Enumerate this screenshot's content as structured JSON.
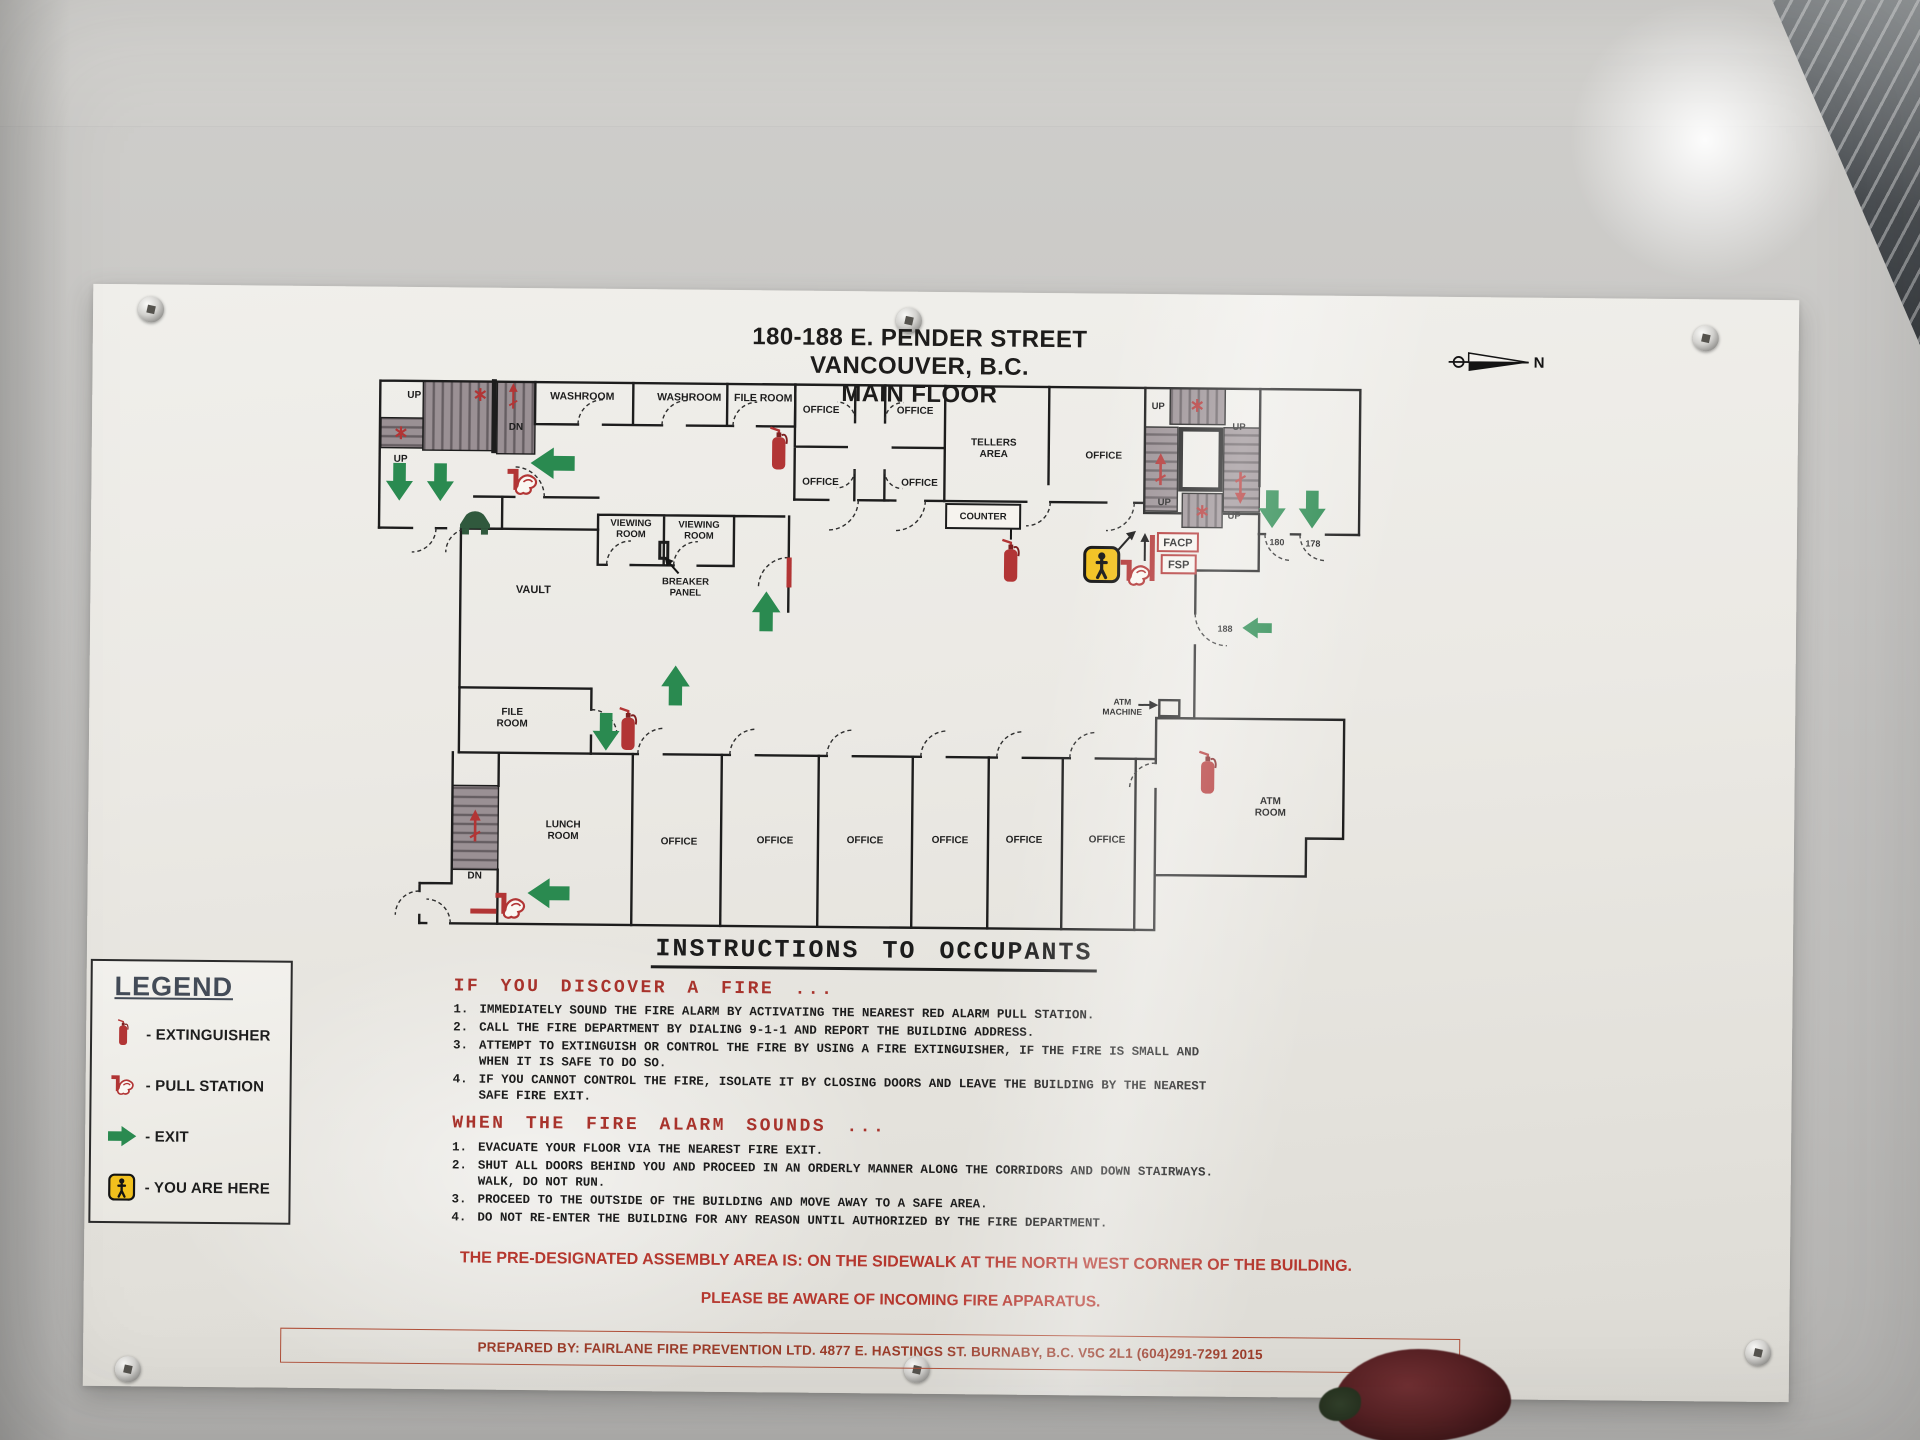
{
  "sign": {
    "title_lines": [
      "180-188 E. PENDER STREET",
      "VANCOUVER, B.C.",
      "MAIN FLOOR"
    ],
    "compass": {
      "label": "N"
    },
    "colors": {
      "alarm_red": "#b23535",
      "exit_green": "#2a8a50",
      "here_yellow": "#f2c11e",
      "heading_red": "#a8332c",
      "stair_fill": "#9a9094"
    },
    "floor_plan": {
      "labels": [
        {
          "t": "UP",
          "x": 39,
          "y": 20,
          "s": 10
        },
        {
          "t": "DN",
          "x": 141,
          "y": 51,
          "s": 10
        },
        {
          "t": "UP",
          "x": 26,
          "y": 84,
          "s": 10
        },
        {
          "t": "WASHROOM",
          "x": 207,
          "y": 20,
          "s": 10.5
        },
        {
          "t": "WASHROOM",
          "x": 314,
          "y": 20,
          "s": 10.5
        },
        {
          "t": "FILE ROOM",
          "x": 388,
          "y": 20,
          "s": 10.5
        },
        {
          "t": "OFFICE",
          "x": 446,
          "y": 31,
          "s": 10
        },
        {
          "t": "OFFICE",
          "x": 540,
          "y": 31,
          "s": 10
        },
        {
          "t": "OFFICE",
          "x": 446,
          "y": 103,
          "s": 10
        },
        {
          "t": "OFFICE",
          "x": 545,
          "y": 103,
          "s": 10
        },
        {
          "t": "TELLERS\nAREA",
          "x": 619,
          "y": 62,
          "s": 10
        },
        {
          "t": "OFFICE",
          "x": 729,
          "y": 74,
          "s": 10
        },
        {
          "t": "UP",
          "x": 783,
          "y": 24,
          "s": 9.5
        },
        {
          "t": "UP",
          "x": 864,
          "y": 44,
          "s": 9.5
        },
        {
          "t": "UP",
          "x": 790,
          "y": 120,
          "s": 9.5
        },
        {
          "t": "UP",
          "x": 860,
          "y": 133,
          "s": 9.5
        },
        {
          "t": "180",
          "x": 903,
          "y": 159,
          "s": 9
        },
        {
          "t": "178",
          "x": 939,
          "y": 160,
          "s": 9
        },
        {
          "t": "188",
          "x": 852,
          "y": 246,
          "s": 9
        },
        {
          "t": "VIEWING\nROOM",
          "x": 257,
          "y": 146,
          "s": 9.5
        },
        {
          "t": "VIEWING\nROOM",
          "x": 325,
          "y": 147,
          "s": 9.5
        },
        {
          "t": "BREAKER\nPANEL",
          "x": 312,
          "y": 204,
          "s": 9.5
        },
        {
          "t": "VAULT",
          "x": 160,
          "y": 214,
          "s": 11
        },
        {
          "t": "FILE\nROOM",
          "x": 140,
          "y": 336,
          "s": 10
        },
        {
          "t": "LUNCH\nROOM",
          "x": 192,
          "y": 448,
          "s": 10
        },
        {
          "t": "DN",
          "x": 104,
          "y": 500,
          "s": 10
        },
        {
          "t": "OFFICE",
          "x": 308,
          "y": 464,
          "s": 10
        },
        {
          "t": "OFFICE",
          "x": 404,
          "y": 462,
          "s": 10
        },
        {
          "t": "OFFICE",
          "x": 494,
          "y": 461,
          "s": 10
        },
        {
          "t": "OFFICE",
          "x": 579,
          "y": 460,
          "s": 10
        },
        {
          "t": "OFFICE",
          "x": 653,
          "y": 459,
          "s": 10
        },
        {
          "t": "OFFICE",
          "x": 736,
          "y": 458,
          "s": 10
        },
        {
          "t": "ATM\nMACHINE",
          "x": 750,
          "y": 320,
          "s": 8.5
        },
        {
          "t": "ATM\nROOM",
          "x": 899,
          "y": 418,
          "s": 10
        }
      ],
      "boxed_labels": [
        {
          "t": "FACP",
          "x": 804,
          "y": 161,
          "s": 11,
          "box": [
            784,
            148,
            40,
            18
          ],
          "c": "#b23535"
        },
        {
          "t": "FSP",
          "x": 805,
          "y": 183,
          "s": 11,
          "box": [
            788,
            170,
            34,
            18
          ],
          "c": "#b23535"
        },
        {
          "t": "COUNTER",
          "x": 609,
          "y": 136,
          "s": 9.5,
          "box": [
            572,
            121,
            74,
            24
          ],
          "c": "#1d1d1d"
        }
      ],
      "icons": [
        {
          "type": "exit-arrow-icon",
          "x": 25,
          "y": 104,
          "rot": 0,
          "s": 0.9
        },
        {
          "type": "exit-arrow-icon",
          "x": 66,
          "y": 104,
          "rot": 0,
          "s": 0.9
        },
        {
          "type": "exit-arrow-icon",
          "x": 178,
          "y": 84,
          "rot": 90,
          "s": 1.05
        },
        {
          "type": "exit-arrow-icon",
          "x": 898,
          "y": 123,
          "rot": 0,
          "s": 0.9
        },
        {
          "type": "exit-arrow-icon",
          "x": 938,
          "y": 123,
          "rot": 0,
          "s": 0.9
        },
        {
          "type": "exit-arrow-icon",
          "x": 234,
          "y": 352,
          "rot": 0,
          "s": 0.9
        },
        {
          "type": "exit-arrow-icon",
          "x": 303,
          "y": 305,
          "rot": 180,
          "s": 0.95
        },
        {
          "type": "exit-arrow-icon",
          "x": 393,
          "y": 230,
          "rot": 180,
          "s": 0.95
        },
        {
          "type": "exit-arrow-icon",
          "x": 884,
          "y": 242,
          "rot": 90,
          "s": 0.7
        },
        {
          "type": "exit-arrow-icon",
          "x": 178,
          "y": 514,
          "rot": 90,
          "s": 1.0
        },
        {
          "type": "extinguisher-icon",
          "x": 404,
          "y": 70,
          "rot": 0,
          "s": 0.95
        },
        {
          "type": "extinguisher-icon",
          "x": 637,
          "y": 180,
          "rot": 0,
          "s": 0.95
        },
        {
          "type": "extinguisher-icon",
          "x": 256,
          "y": 352,
          "rot": 0,
          "s": 0.95
        },
        {
          "type": "extinguisher-icon",
          "x": 836,
          "y": 390,
          "rot": 0,
          "s": 0.95
        },
        {
          "type": "pull-station-icon",
          "x": 148,
          "y": 103,
          "rot": 0,
          "s": 1
        },
        {
          "type": "pull-station-icon",
          "x": 762,
          "y": 188,
          "rot": 0,
          "s": 1
        },
        {
          "type": "pull-station-icon",
          "x": 140,
          "y": 527,
          "rot": 0,
          "s": 1
        },
        {
          "type": "stair-arrow-icon",
          "x": 138,
          "y": 17,
          "rot": 0,
          "s": 0.8
        },
        {
          "type": "stair-arrow-icon",
          "x": 786,
          "y": 84,
          "rot": 0,
          "s": 1
        },
        {
          "type": "stair-arrow-icon",
          "x": 866,
          "y": 102,
          "rot": 180,
          "s": 1
        },
        {
          "type": "stair-arrow-icon",
          "x": 104,
          "y": 447,
          "rot": 0,
          "s": 1
        },
        {
          "type": "stair-marker-icon",
          "x": 105,
          "y": 16,
          "rot": 0,
          "s": 0.8
        },
        {
          "type": "stair-marker-icon",
          "x": 26,
          "y": 55,
          "rot": 0,
          "s": 0.8
        },
        {
          "type": "stair-marker-icon",
          "x": 822,
          "y": 20,
          "rot": 0,
          "s": 0.8
        },
        {
          "type": "stair-marker-icon",
          "x": 828,
          "y": 126,
          "rot": 0,
          "s": 0.8
        },
        {
          "type": "you-are-here-icon",
          "x": 728,
          "y": 180,
          "rot": 0,
          "s": 1
        },
        {
          "type": "equipment-icon",
          "x": 101,
          "y": 143,
          "rot": 0,
          "s": 1
        }
      ]
    },
    "legend": {
      "title": "LEGEND",
      "items": [
        {
          "icon": "extinguisher-icon",
          "label": "- EXTINGUISHER"
        },
        {
          "icon": "pull-station-icon",
          "label": "- PULL STATION"
        },
        {
          "icon": "exit-arrow-icon",
          "label": "- EXIT"
        },
        {
          "icon": "you-are-here-icon",
          "label": "- YOU ARE HERE"
        }
      ]
    },
    "instructions": {
      "heading": "INSTRUCTIONS TO OCCUPANTS",
      "sections": [
        {
          "title": "IF YOU DISCOVER A FIRE ...",
          "items": [
            "IMMEDIATELY SOUND THE FIRE ALARM BY ACTIVATING THE NEAREST RED ALARM PULL STATION.",
            "CALL THE FIRE DEPARTMENT BY DIALING 9-1-1 AND REPORT THE BUILDING ADDRESS.",
            "ATTEMPT TO EXTINGUISH OR CONTROL THE FIRE BY USING A FIRE EXTINGUISHER, IF THE FIRE IS SMALL AND WHEN IT IS SAFE TO DO SO.",
            "IF YOU CANNOT CONTROL THE FIRE, ISOLATE IT BY CLOSING DOORS AND LEAVE THE BUILDING BY THE NEAREST SAFE FIRE EXIT."
          ]
        },
        {
          "title": "WHEN THE FIRE ALARM SOUNDS ...",
          "items": [
            "EVACUATE YOUR FLOOR VIA THE NEAREST FIRE EXIT.",
            "SHUT ALL DOORS BEHIND YOU AND PROCEED IN AN ORDERLY MANNER ALONG THE CORRIDORS AND DOWN STAIRWAYS. WALK, DO NOT RUN.",
            "PROCEED TO THE OUTSIDE OF THE BUILDING AND MOVE AWAY TO A SAFE AREA.",
            "DO NOT RE-ENTER THE BUILDING FOR ANY REASON UNTIL AUTHORIZED BY THE FIRE DEPARTMENT."
          ]
        }
      ],
      "assembly_note": "THE PRE-DESIGNATED ASSEMBLY AREA IS: ON THE SIDEWALK AT THE NORTH WEST CORNER OF THE BUILDING.",
      "apparatus_note": "PLEASE BE AWARE OF INCOMING FIRE APPARATUS.",
      "prepared_by": "PREPARED BY:  FAIRLANE FIRE PREVENTION LTD. 4877 E. HASTINGS ST. BURNABY, B.C. V5C 2L1 (604)291-7291  2015"
    }
  }
}
